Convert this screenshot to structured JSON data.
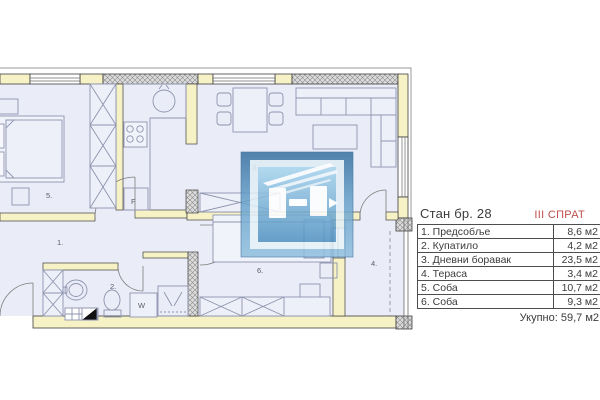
{
  "panel": {
    "apartment_title": "Стан бр. 28",
    "floor_label": "III СПРАТ",
    "rows": [
      {
        "label": "1. Предсобље",
        "value": "8,6 м2"
      },
      {
        "label": "2. Купатило",
        "value": "4,2 м2"
      },
      {
        "label": "3. Дневни боравак",
        "value": "23,5 м2"
      },
      {
        "label": "4. Тераса",
        "value": "3,4 м2"
      },
      {
        "label": "5. Соба",
        "value": "10,7 м2"
      },
      {
        "label": "6. Соба",
        "value": "9,3 м2"
      }
    ],
    "total_label": "Укупно: 59,7 м2"
  },
  "plan": {
    "room_labels": {
      "hallway": "1.",
      "bathroom": "2.",
      "living": "3.",
      "terrace": "4.",
      "room5": "5.",
      "room6": "6."
    },
    "appliance_labels": {
      "fridge": "F",
      "washer": "W"
    }
  },
  "colors": {
    "wall_fill": "#f6f2c6",
    "floor_fill": "#eaecf7",
    "furniture_line": "#8d94ae",
    "accent_red": "#bf4d4d",
    "logo_blue": "#4a8fc0"
  }
}
